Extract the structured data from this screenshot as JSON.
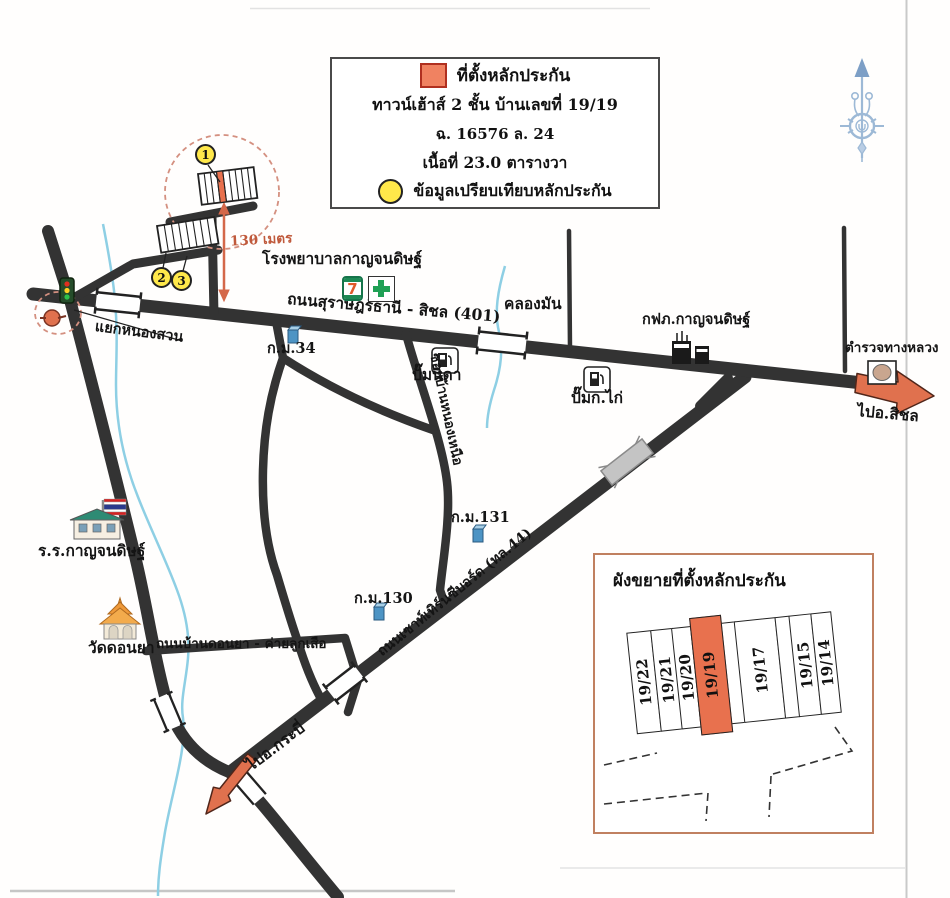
{
  "legend": {
    "collateral_label": "ที่ตั้งหลักประกัน",
    "line_building": "ทาวน์เฮ้าส์ 2 ชั้น บ้านเลขที่ 19/19",
    "line_deed": "ฉ. 16576 ล. 24",
    "line_area": "เนื้อที่ 23.0 ตารางวา",
    "comparison_label": "ข้อมูลเปรียบเทียบหลักประกัน"
  },
  "badges": {
    "b1": "1",
    "b2": "2",
    "b3": "3"
  },
  "labels": {
    "hospital": "โรงพยาบาลกาญจนดิษฐ์",
    "road401": "ถนนสุราษฎร์ธานี - สิชล (401)",
    "klong_man": "คลองมัน",
    "km34": "ก.ม.34",
    "pump_nida": "ปั๊มนิดา",
    "soi": "ซอยบ้านหนองเหนือ",
    "pump_kokai": "ปั๊มก.ไก่",
    "pea": "กฟภ.กาญจนดิษฐ์",
    "highway_police": "ตำรวจทางหลวง",
    "to_sichon": "ไปอ.สิชล",
    "yaek_nong_suan": "แยกหนองสวน",
    "school": "ร.ร.กาญจนดิษฐ์",
    "wat_donya": "วัดดอนยา",
    "donya_road": "ถนนบ้านดอนยา - ค่ายลูกเสือ",
    "km130": "ก.ม.130",
    "km131": "ก.ม.131",
    "hwy44": "ถนนเซาท์เทิร์นซีบอร์ด (ทล.44)",
    "to_krabi": "ไปอ.กระบี่",
    "distance": "130 เมตร",
    "seven": "7"
  },
  "inset": {
    "title": "ผังขยายที่ตั้งหลักประกัน",
    "plots": [
      {
        "label": "19/22",
        "highlight": false
      },
      {
        "label": "19/21",
        "highlight": false
      },
      {
        "label": "19/20",
        "highlight": false
      },
      {
        "label": "19/19",
        "highlight": true
      },
      {
        "label": "",
        "highlight": false
      },
      {
        "label": "19/17",
        "highlight": false
      },
      {
        "label": "",
        "highlight": false
      },
      {
        "label": "19/15",
        "highlight": false
      },
      {
        "label": "19/14",
        "highlight": false
      }
    ]
  },
  "colors": {
    "accent": "#e0714e",
    "badge_yellow": "#ffe84a",
    "road": "#333333",
    "canal": "#8ecfe4",
    "compass": "#9db9d6",
    "inset_border": "#c08060"
  }
}
